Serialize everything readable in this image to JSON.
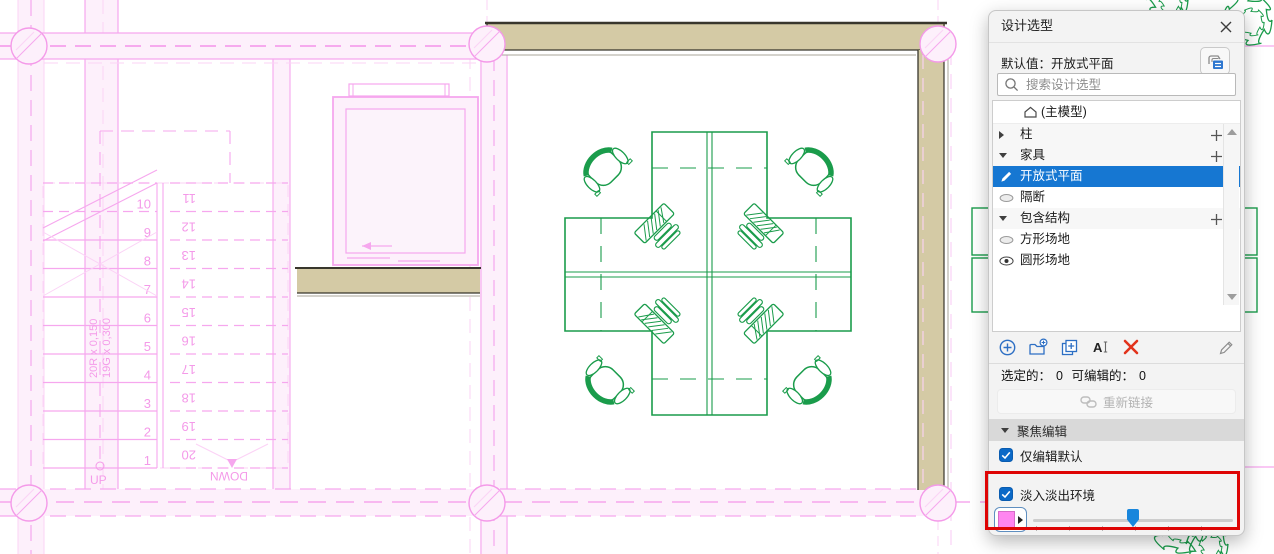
{
  "panel": {
    "title": "设计选型",
    "default_value_label": "默认值：开放式平面",
    "search_placeholder": "搜索设计选型",
    "tree": {
      "root_label": "(主模型)",
      "rows": [
        {
          "type": "category",
          "label": "柱",
          "expanded": false,
          "addable": true
        },
        {
          "type": "category",
          "label": "家具",
          "expanded": true,
          "addable": true
        },
        {
          "type": "option",
          "label": "开放式平面",
          "icon": "pencil",
          "selected": true
        },
        {
          "type": "option",
          "label": "隔断",
          "icon": "eye-closed",
          "selected": false
        },
        {
          "type": "category",
          "label": "包含结构",
          "expanded": true,
          "addable": true
        },
        {
          "type": "option",
          "label": "方形场地",
          "icon": "eye-closed",
          "selected": false
        },
        {
          "type": "option",
          "label": "圆形场地",
          "icon": "eye-open",
          "selected": false
        }
      ]
    },
    "toolbar": {
      "rename_glyph": "A"
    },
    "status_selected_label": "选定的：",
    "status_selected_value": "0",
    "status_editable_label": "可编辑的：",
    "status_editable_value": "0",
    "relink_label": "重新链接",
    "focus_edit_label": "聚焦编辑",
    "only_edit_default_label": "仅编辑默认",
    "fade_env_label": "淡入淡出环境",
    "fade": {
      "swatch_color": "#ff85f0",
      "slider_pct": 50
    }
  },
  "canvas": {
    "up_label": "UP",
    "down_label": "DOWN",
    "stair_run_text_1": "20R x 0,150",
    "stair_run_text_2": "19G x 0,300",
    "stair_numbers_left": [
      "1",
      "2",
      "3",
      "4",
      "5",
      "6",
      "7",
      "8",
      "9",
      "10"
    ],
    "stair_numbers_right": [
      "11",
      "12",
      "13",
      "14",
      "15",
      "16",
      "17",
      "18",
      "19",
      "20"
    ],
    "colors": {
      "faded_strong": "#f27fe5",
      "faded_med": "#f6a7ee",
      "faded_light": "#fbd3f6",
      "faded_fill": "#fdf0fb",
      "wall_fill": "#d4caa5",
      "wall_edge": "#38362c",
      "option_green": "#1a9c4b",
      "selection_blue": "#1677d2",
      "highlight_red": "#de0404"
    }
  }
}
